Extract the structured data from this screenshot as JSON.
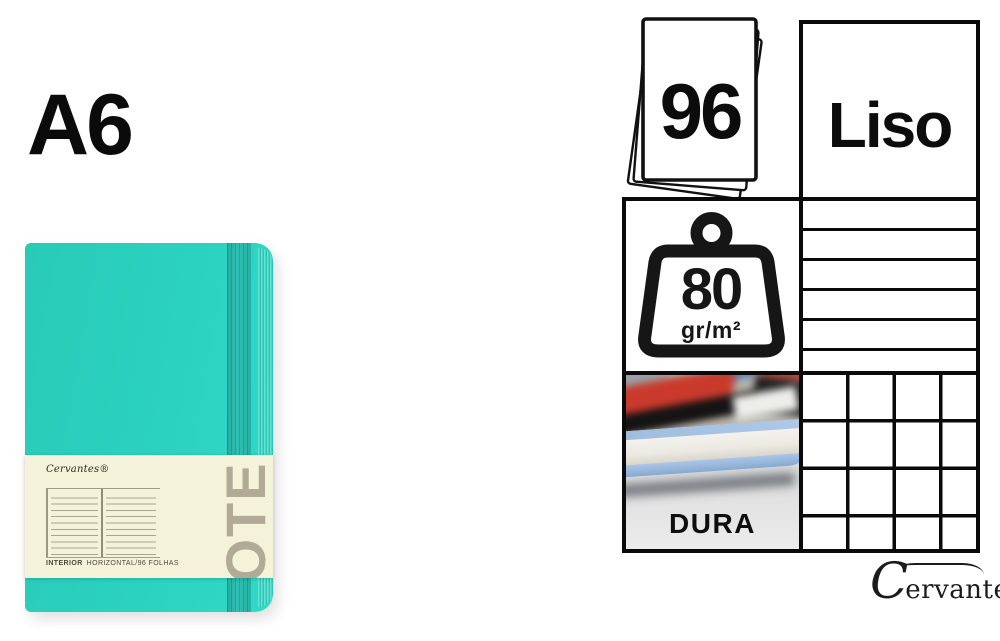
{
  "page": {
    "size_label": "A6",
    "background_color": "#ffffff",
    "line_color": "#0a0a0a"
  },
  "notebook": {
    "brand_logo": "Cervantes®",
    "note_watermark": "NOTE",
    "caption_bold": "INTERIOR",
    "caption_rest": "HORIZONTAL/96 FOLHAS",
    "colors": {
      "cover_teal": "#2bd2bf",
      "elastic_band": "#1cafa2",
      "belly_band": "#f5f2da",
      "watermark": "#aca58f"
    }
  },
  "specs": {
    "sheet_count": "96",
    "paper_style": "Liso",
    "paper_weight_value": "80",
    "paper_weight_unit": "gr/m²",
    "cover_hardness": "DURA"
  },
  "footer_brand": {
    "initial": "C",
    "name_rest": "ervantes",
    "registered": "®"
  }
}
